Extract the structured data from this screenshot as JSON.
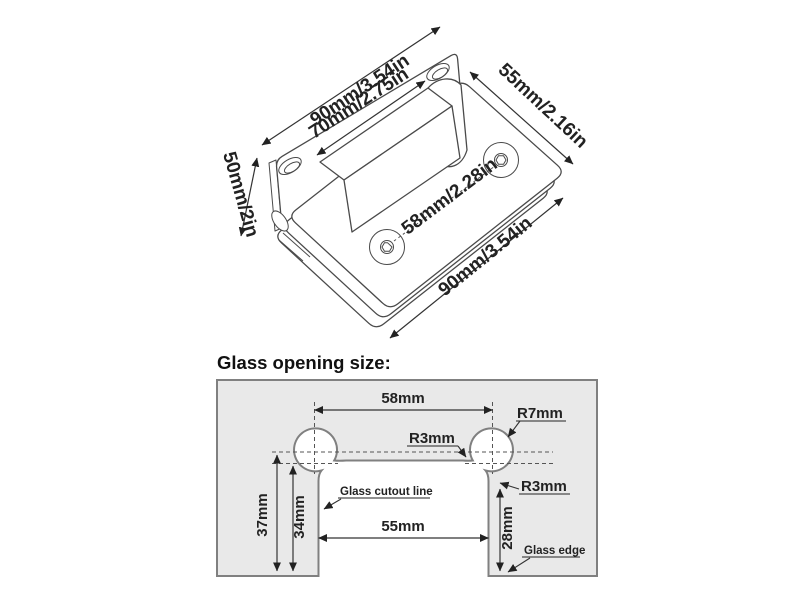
{
  "hinge_diagram": {
    "dim_plate_length": "90mm/3.54in",
    "dim_clamp_width": "55mm/2.16in",
    "dim_leaf_width": "70mm/2.75in",
    "dim_plate_height": "50mm/2in",
    "dim_screw_spacing": "58mm/2.28in",
    "dim_clamp_length": "90mm/3.54in"
  },
  "glass_opening": {
    "heading": "Glass opening size:",
    "dim_hole_spacing": "58mm",
    "radius_lobe": "R7mm",
    "radius_slot_fillet": "R3mm",
    "radius_corner_fillet": "R3mm",
    "dim_depth_to_center": "37mm",
    "dim_cutout_depth": "34mm",
    "dim_cutout_width": "55mm",
    "dim_edge_depth": "28mm",
    "label_cutout_line": "Glass cutout line",
    "label_glass_edge": "Glass edge"
  }
}
